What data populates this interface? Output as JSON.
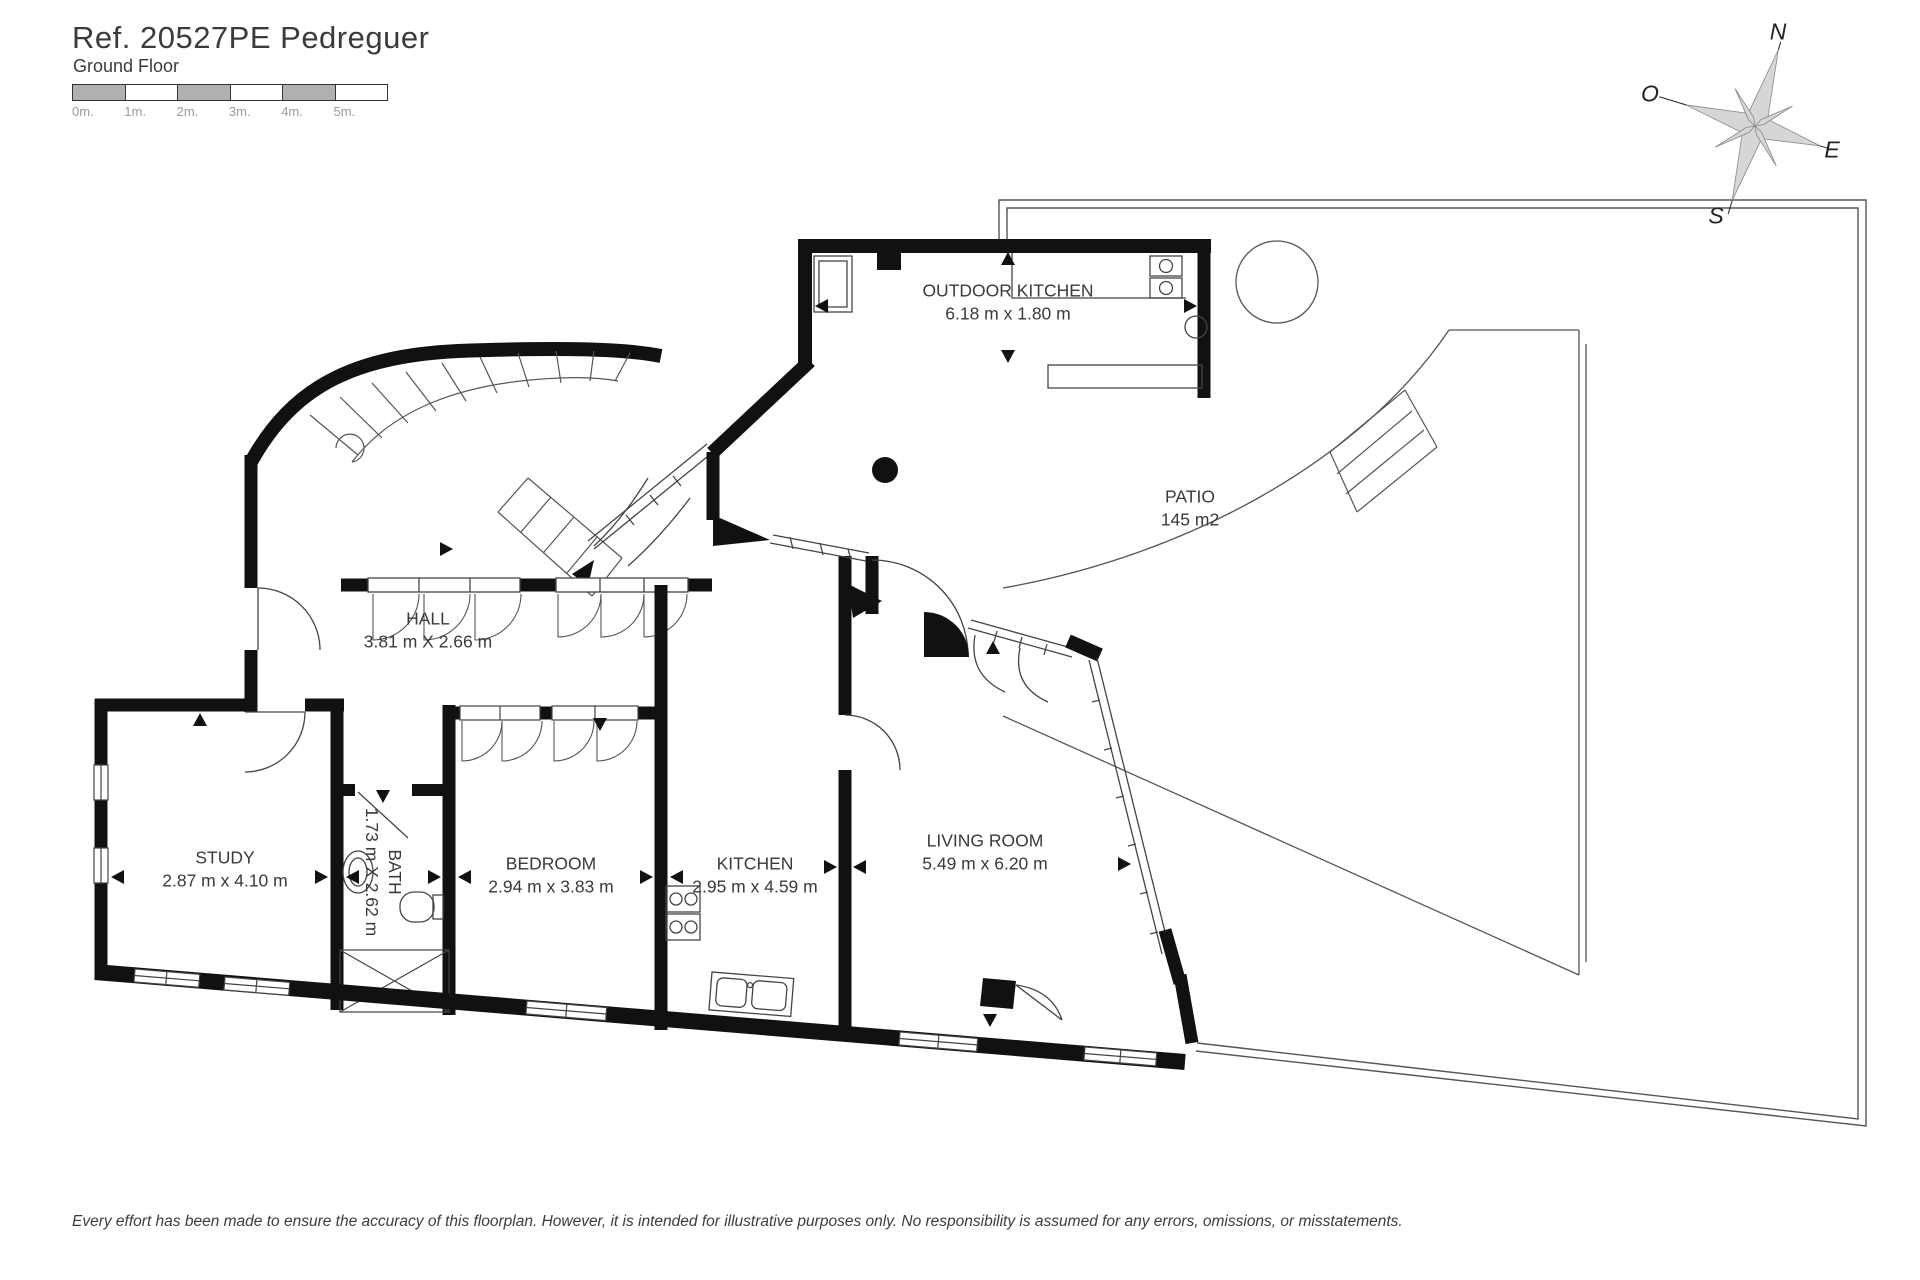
{
  "header": {
    "title": "Ref. 20527PE Pedreguer",
    "subtitle": "Ground Floor"
  },
  "scale_bar": {
    "labels": [
      "0m.",
      "1m.",
      "2m.",
      "3m.",
      "4m.",
      "5m."
    ]
  },
  "compass": {
    "n": "N",
    "e": "E",
    "s": "S",
    "w": "O"
  },
  "rooms": {
    "outdoor_kitchen": {
      "name": "OUTDOOR KITCHEN",
      "dims": "6.18 m x 1.80 m"
    },
    "patio": {
      "name": "PATIO",
      "dims": "145 m2"
    },
    "hall": {
      "name": "HALL",
      "dims": "3.81 m X 2.66 m"
    },
    "study": {
      "name": "STUDY",
      "dims": "2.87 m x 4.10 m"
    },
    "bath": {
      "name": "BATH",
      "dims": "1.73 m X 2.62 m"
    },
    "bedroom": {
      "name": "BEDROOM",
      "dims": "2.94 m x 3.83 m"
    },
    "kitchen": {
      "name": "KITCHEN",
      "dims": "2.95 m x 4.59 m"
    },
    "living_room": {
      "name": "LIVING ROOM",
      "dims": "5.49 m x 6.20 m"
    }
  },
  "footer": {
    "disclaimer": "Every effort has been made to ensure the accuracy of this floorplan. However, it is intended for illustrative purposes only. No responsibility is assumed for any errors, omissions, or misstatements."
  },
  "colors": {
    "wall": "#111111",
    "thin": "#555555",
    "text": "#3a3a3a",
    "scale_gray": "#b0b0b0"
  }
}
